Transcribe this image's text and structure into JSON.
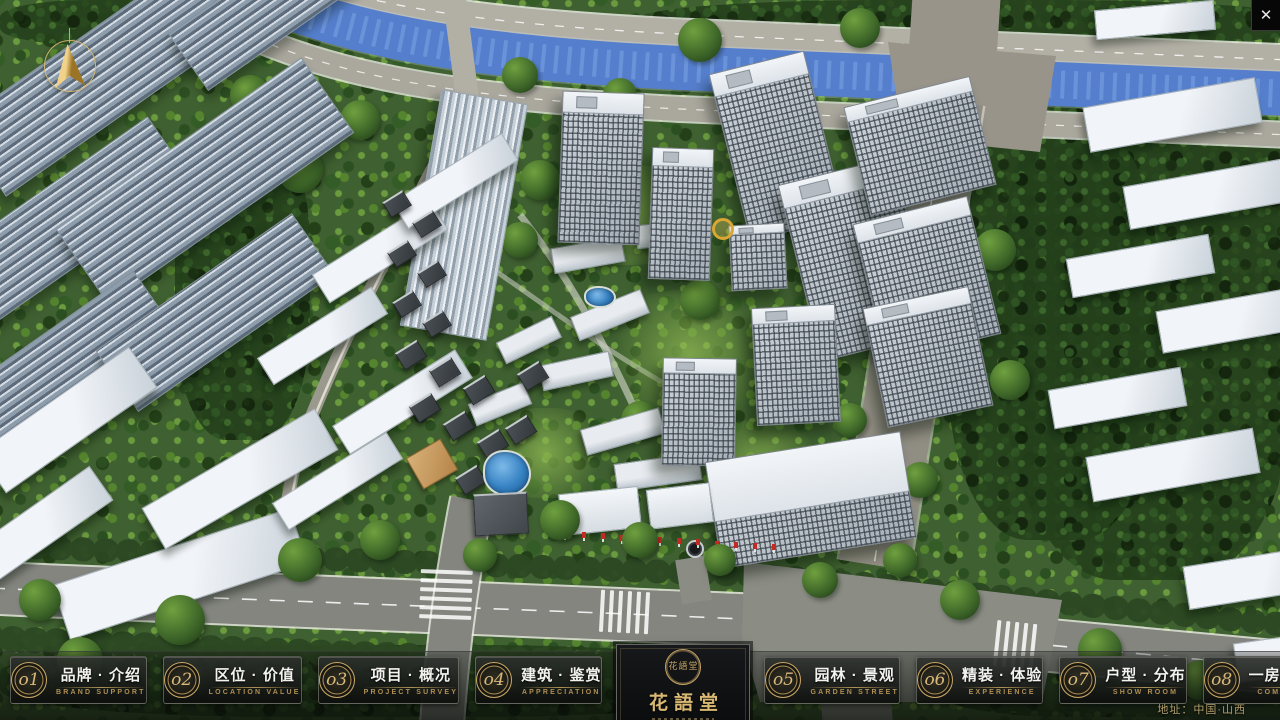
{
  "icons": {
    "close": "✕",
    "compass": "north-arrow"
  },
  "colors": {
    "gold_accent": "#c9a763",
    "panel_dark": "#101210",
    "river_blue": "#2f66c8",
    "flag_red": "#c32a22"
  },
  "navbar": {
    "items": [
      {
        "num": "o1",
        "label": "品牌 · 介绍",
        "sublabel": "BRAND SUPPORT"
      },
      {
        "num": "o2",
        "label": "区位 · 价值",
        "sublabel": "LOCATION VALUE"
      },
      {
        "num": "o3",
        "label": "项目 · 概况",
        "sublabel": "PROJECT SURVEY"
      },
      {
        "num": "o4",
        "label": "建筑 · 鉴赏",
        "sublabel": "APPRECIATION"
      },
      {
        "num": "o5",
        "label": "园林 · 景观",
        "sublabel": "GARDEN STREET"
      },
      {
        "num": "o6",
        "label": "精装 · 体验",
        "sublabel": "EXPERIENCE"
      },
      {
        "num": "o7",
        "label": "户型 · 分布",
        "sublabel": "SHOW ROOM"
      },
      {
        "num": "o8",
        "label": "一房 · 一景",
        "sublabel": "COMMUNITY"
      }
    ],
    "logo": {
      "title": "花語堂",
      "seal_text": "花語堂"
    },
    "address": "地址：中国·山西"
  }
}
